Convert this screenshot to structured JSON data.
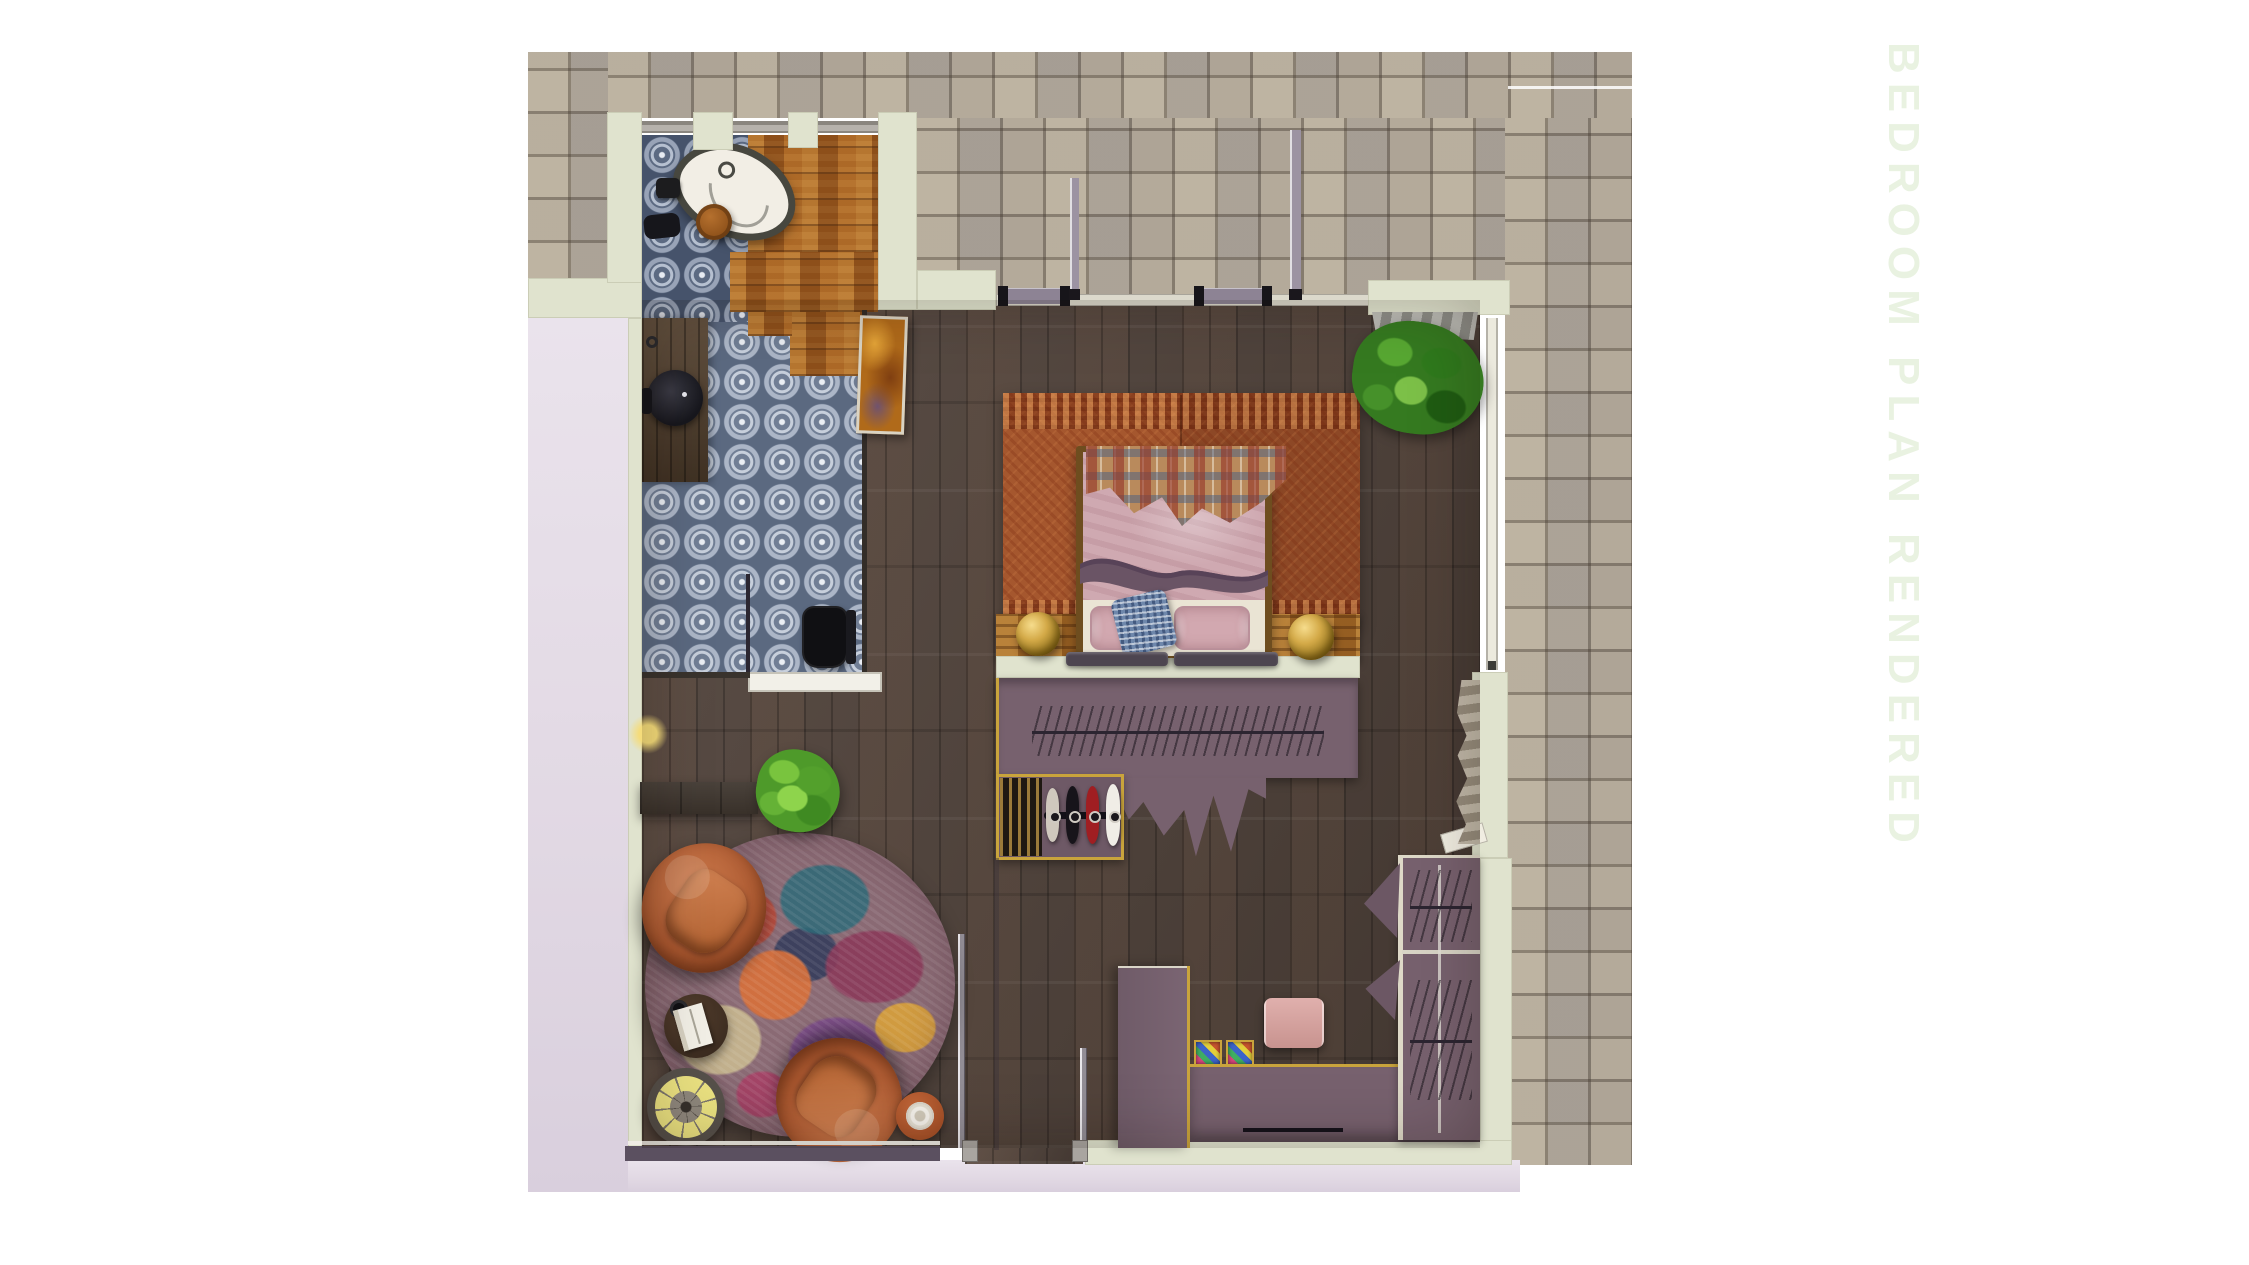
{
  "title": {
    "text": "BEDROOM PLAN RENDERED"
  },
  "palette": {
    "background": "#ffffff",
    "title_text": "#e9f2e1",
    "pavers": "#b1a79a",
    "exterior_lavender": "#e4dce6",
    "wall_cream": "#e0e3ce",
    "bathroom_tile_blue": "#4d5a74",
    "amber_wood": "#9a5a20",
    "walnut_floor": "#52443c",
    "bed_rug_rust": "#a5572e",
    "wardrobe_purple": "#77616e",
    "leather_chair": "#b5623a",
    "bedding_pink": "#d2a8b0",
    "accent_gold": "#c9a43c"
  },
  "plan": {
    "label": "top-down rendered bedroom floor plan",
    "areas": [
      "bathroom",
      "bedroom",
      "sitting-area",
      "closet-dressing",
      "stone-patio",
      "exterior-walk"
    ],
    "furniture": [
      "freestanding-bathtub",
      "vanity-vessel-sink",
      "toilet",
      "double-bed",
      "plaid-throw",
      "pillows",
      "gold-sphere-lamps",
      "wardrobe-hanging-rail",
      "clothes-on-rail",
      "leather-lounge-chairs",
      "abstract-round-rug",
      "book-side-table",
      "spoke-drink-table",
      "terracotta-side-table",
      "potted-plants",
      "window-curtain",
      "pink-ottoman",
      "storage-baskets",
      "wood-bench",
      "wall-artwork"
    ]
  }
}
